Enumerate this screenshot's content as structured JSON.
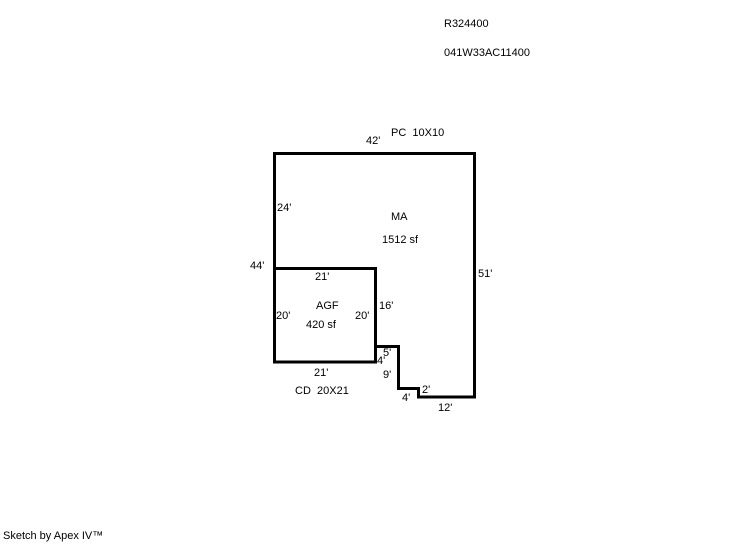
{
  "page": {
    "background_color": "#ffffff",
    "line_color": "#000000",
    "text_color": "#000000"
  },
  "header": {
    "record_id": "R324400",
    "parcel_id": "041W33AC11400"
  },
  "sketch": {
    "areas": [
      {
        "code": "MA",
        "size": "1512 sf"
      },
      {
        "code": "AGF",
        "size": "420 sf"
      },
      {
        "code": "PC",
        "dimensions": "10X10"
      },
      {
        "code": "CD",
        "dimensions": "20X21"
      }
    ],
    "paths": {
      "outline": "M 274.5 153.5 L 474.5 153.5 L 474.5 397 L 418.5 397 L 418.5 388.5 L 398.5 388.5 L 398.5 346.5 L 375.5 346.5 L 375.5 362 L 274.5 362 Z",
      "agf": "M 274.5 268.5 L 375.5 268.5 L 375.5 362"
    },
    "labels": [
      {
        "name": "label-pc",
        "text": "PC  10X10",
        "x": 391,
        "y": 128
      },
      {
        "name": "dim-top-42",
        "text": "42'",
        "x": 366,
        "y": 136
      },
      {
        "name": "dim-left-24",
        "text": "24'",
        "x": 277,
        "y": 203
      },
      {
        "name": "label-ma",
        "text": "MA",
        "x": 391,
        "y": 212
      },
      {
        "name": "label-ma-area",
        "text": "1512 sf",
        "x": 382,
        "y": 235
      },
      {
        "name": "dim-left-44",
        "text": "44'",
        "x": 250,
        "y": 261
      },
      {
        "name": "dim-agf-top-21",
        "text": "21'",
        "x": 315,
        "y": 272
      },
      {
        "name": "dim-right-51",
        "text": "51'",
        "x": 478,
        "y": 269
      },
      {
        "name": "label-agf",
        "text": "AGF",
        "x": 316,
        "y": 301
      },
      {
        "name": "dim-16",
        "text": "16'",
        "x": 379,
        "y": 301
      },
      {
        "name": "dim-agf-left-20",
        "text": "20'",
        "x": 276,
        "y": 311
      },
      {
        "name": "dim-agf-right-20",
        "text": "20'",
        "x": 355,
        "y": 311
      },
      {
        "name": "label-agf-area",
        "text": "420 sf",
        "x": 306,
        "y": 320
      },
      {
        "name": "dim-5",
        "text": "5'",
        "x": 383,
        "y": 348
      },
      {
        "name": "dim-4-upper",
        "text": "4'",
        "x": 377,
        "y": 356
      },
      {
        "name": "dim-agf-bottom-21",
        "text": "21'",
        "x": 314,
        "y": 368
      },
      {
        "name": "dim-9",
        "text": "9'",
        "x": 383,
        "y": 370
      },
      {
        "name": "label-cd",
        "text": "CD  20X21",
        "x": 295,
        "y": 386
      },
      {
        "name": "dim-2",
        "text": "2'",
        "x": 422,
        "y": 385
      },
      {
        "name": "dim-4-lower",
        "text": "4'",
        "x": 402,
        "y": 393
      },
      {
        "name": "dim-12",
        "text": "12'",
        "x": 438,
        "y": 403
      }
    ]
  },
  "footer": {
    "credit": "Sketch by Apex IV™"
  }
}
